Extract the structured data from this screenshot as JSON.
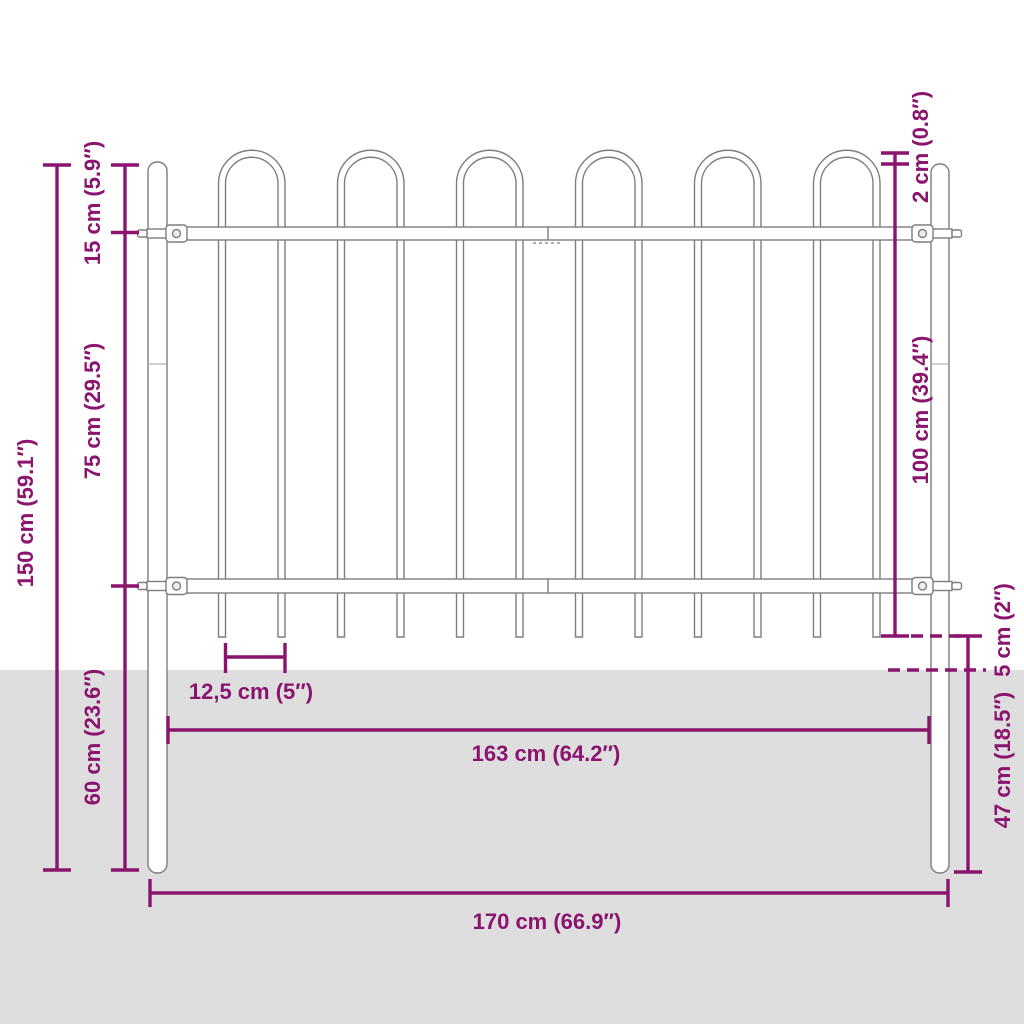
{
  "diagram": {
    "title": "Garden fence panel with hoop top - dimension diagram",
    "colors": {
      "dimension_lines": "#8A146E",
      "ground": "#DEDEDE",
      "fence_outline": "#7E7E7E",
      "background": "#FFFFFF"
    },
    "labels": {
      "total_height": "150 cm (59.1″)",
      "top_section_height": "15 cm (5.9″)",
      "mid_section_height": "75 cm (29.5″)",
      "bottom_section_height": "60 cm (23.6″)",
      "hoop_top_offset": "2 cm (0.8″)",
      "panel_height": "100 cm (39.4″)",
      "ground_clearance": "5 cm (2″)",
      "below_ground_depth": "47 cm (18.5″)",
      "bar_spacing": "12,5 cm (5″)",
      "panel_width": "163 cm (64.2″)",
      "total_width": "170 cm (66.9″)"
    },
    "structure": {
      "hoops": 6,
      "vertical_bars": 12,
      "posts": 2,
      "horizontal_rails": 2
    }
  }
}
